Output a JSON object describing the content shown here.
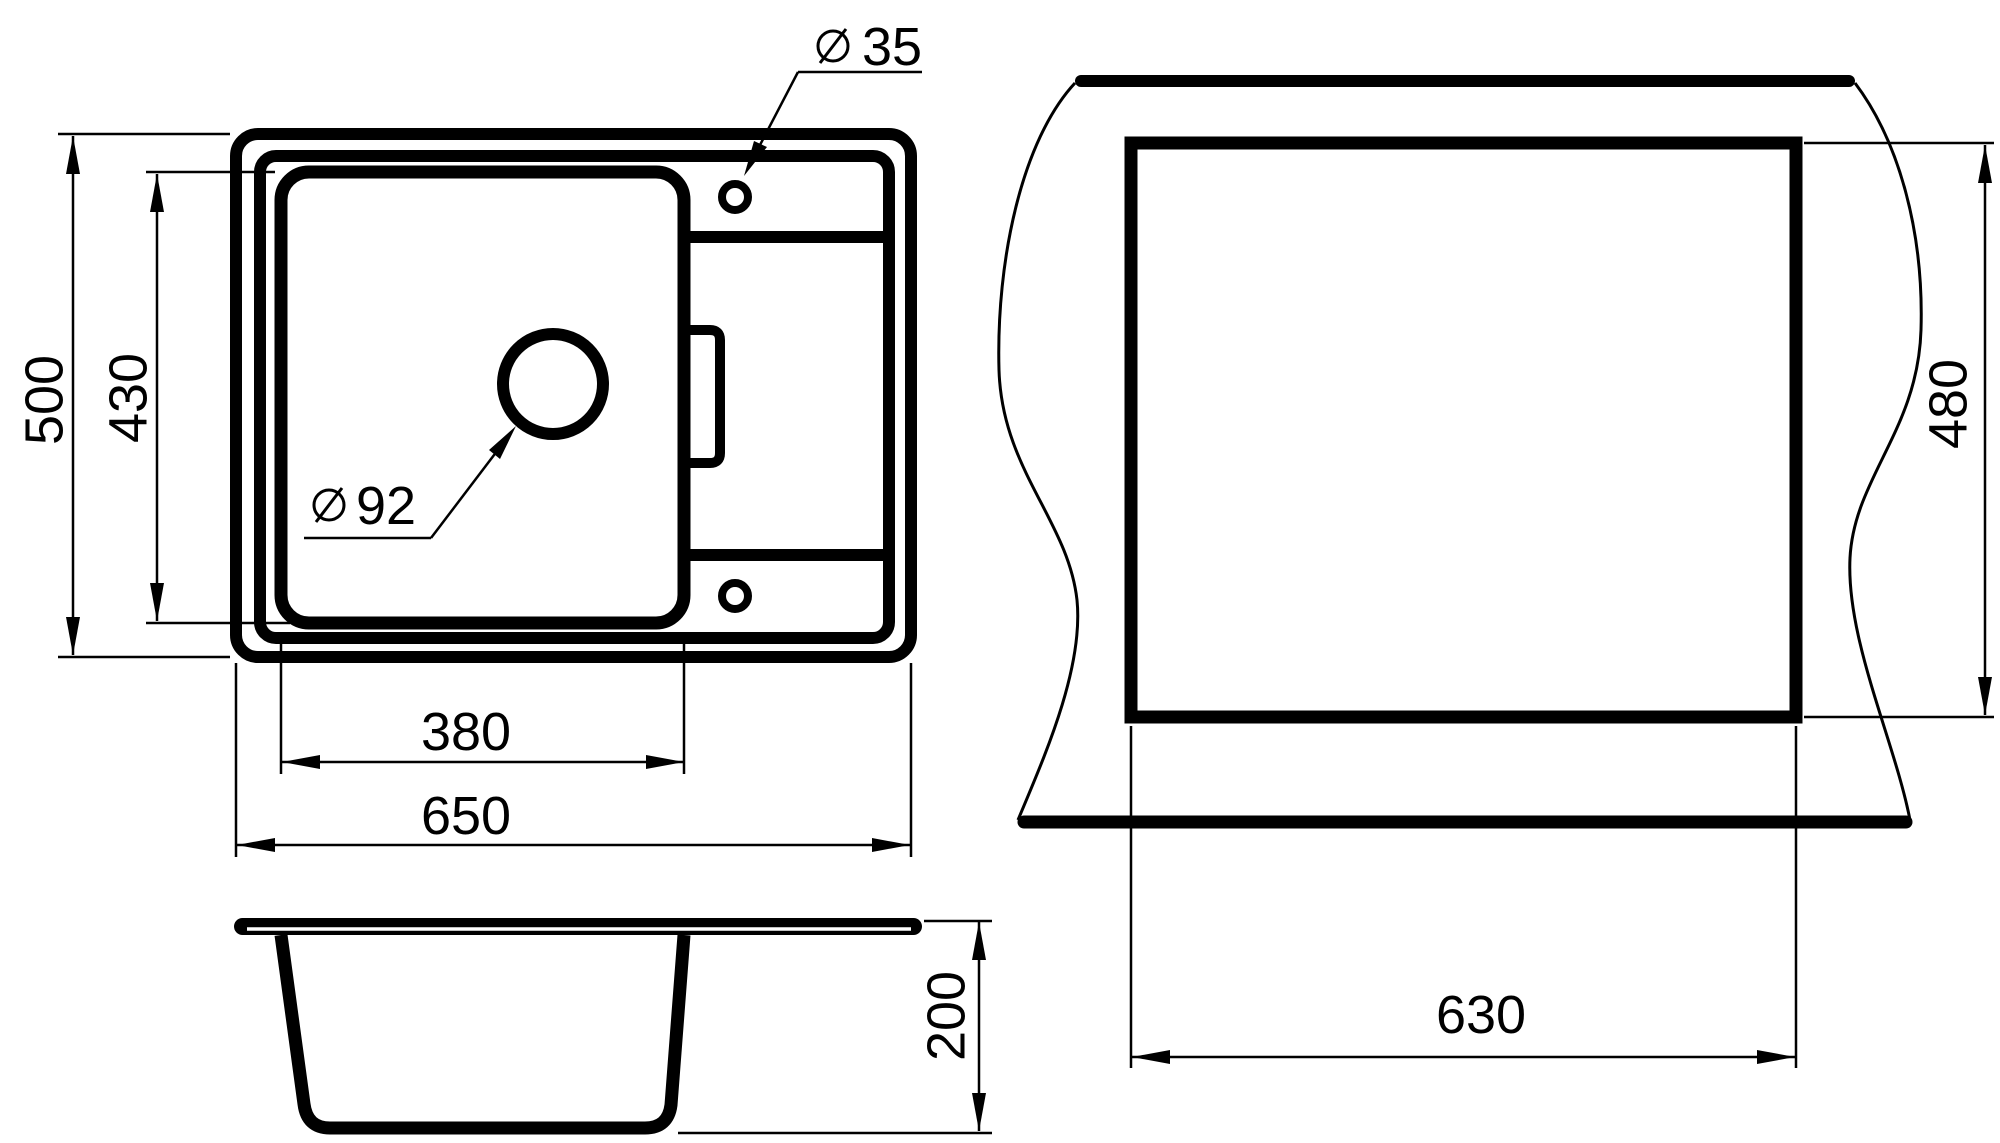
{
  "document": {
    "type": "technical-drawing",
    "subject": "kitchen sink with drainboard — dimensioned views"
  },
  "colors": {
    "background": "#ffffff",
    "line": "#000000"
  },
  "symbols": {
    "diameter_symbol": "⌀"
  },
  "dimensions": {
    "overall_width": "650",
    "overall_depth": "500",
    "bowl_width": "380",
    "bowl_depth": "430",
    "faucet_hole_diameter": "35",
    "drain_hole_diameter": "92",
    "cutout_width": "630",
    "cutout_depth": "480",
    "bowl_height": "200"
  }
}
